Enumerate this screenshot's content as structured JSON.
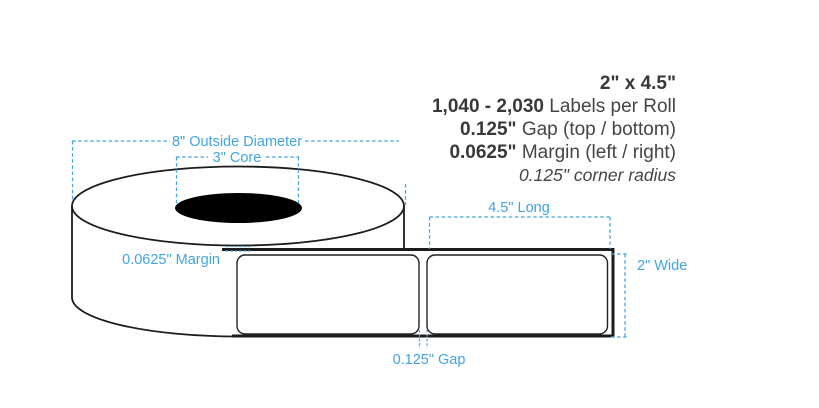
{
  "specs": {
    "size": "2\" x 4.5\"",
    "labels_per_roll_value": "1,040 - 2,030",
    "labels_per_roll_label": "Labels per Roll",
    "gap_value": "0.125\"",
    "gap_label": "Gap (top / bottom)",
    "margin_value": "0.0625\"",
    "margin_label": "Margin (left / right)",
    "corner_radius_note": "0.125\" corner radius"
  },
  "annotations": {
    "outside_diameter": "8\" Outside Diameter",
    "core": "3\" Core",
    "margin": "0.0625\" Margin",
    "length": "4.5\" Long",
    "width": "2\" Wide",
    "gap": "0.125\" Gap"
  },
  "colors": {
    "annotation_blue": "#42a5dc",
    "outline_black": "#1c1c1c",
    "core_fill": "#000000",
    "label_fill": "#ffffff",
    "spec_value_color": "#383838",
    "spec_text_color": "#454545"
  }
}
